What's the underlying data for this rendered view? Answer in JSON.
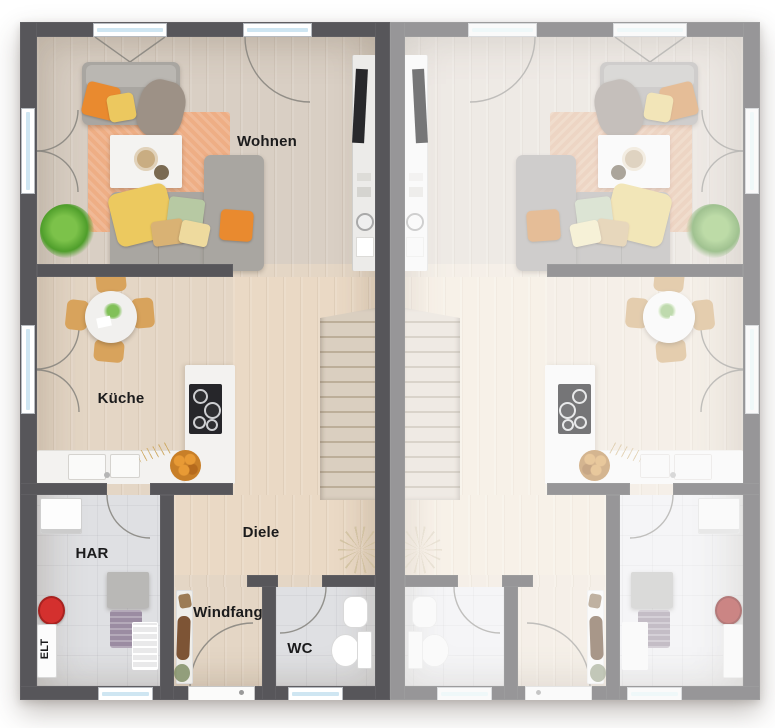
{
  "labels": {
    "living": "Wohnen",
    "kitchen": "Küche",
    "hallway": "Diele",
    "vestibule": "Windfang",
    "wc": "WC",
    "utility_room": "HAR",
    "electrical": "ELT"
  },
  "palette": {
    "wall": "#57565a",
    "glass": "#cfe6f2",
    "arc": "#85827c",
    "floorLiving": "#d9cfc4",
    "floorWarm": "#e4d6c5",
    "floorDiele": "#ead9c5",
    "floorTile": "#dfe0e3",
    "rug": "#eeae85",
    "sofa": "#a9a6a1",
    "sofaBack": "#bab7b2",
    "drape": "#9d9186",
    "pillowOrange": "#e98a2f",
    "pillowYellow": "#ecc85f",
    "pillowGreen": "#b7c9a3",
    "pillowBeige": "#d9b274",
    "pillowPale": "#eeda9e",
    "throwYellow": "#ecc95f",
    "chair": "#d8a35c",
    "counter": "#f3f2f0",
    "cooktop": "#26262a",
    "stair": "#dacfc0",
    "stairLine": "#bcae99",
    "plant": "#4f9e2b",
    "red": "#d4302e",
    "coat": "#7d5435",
    "basket": "#9b8ca2",
    "grayBox": "#b9b8b6",
    "tray": "#c9ad82",
    "fruit": "#c87f28",
    "label": "#1b1b1c"
  }
}
